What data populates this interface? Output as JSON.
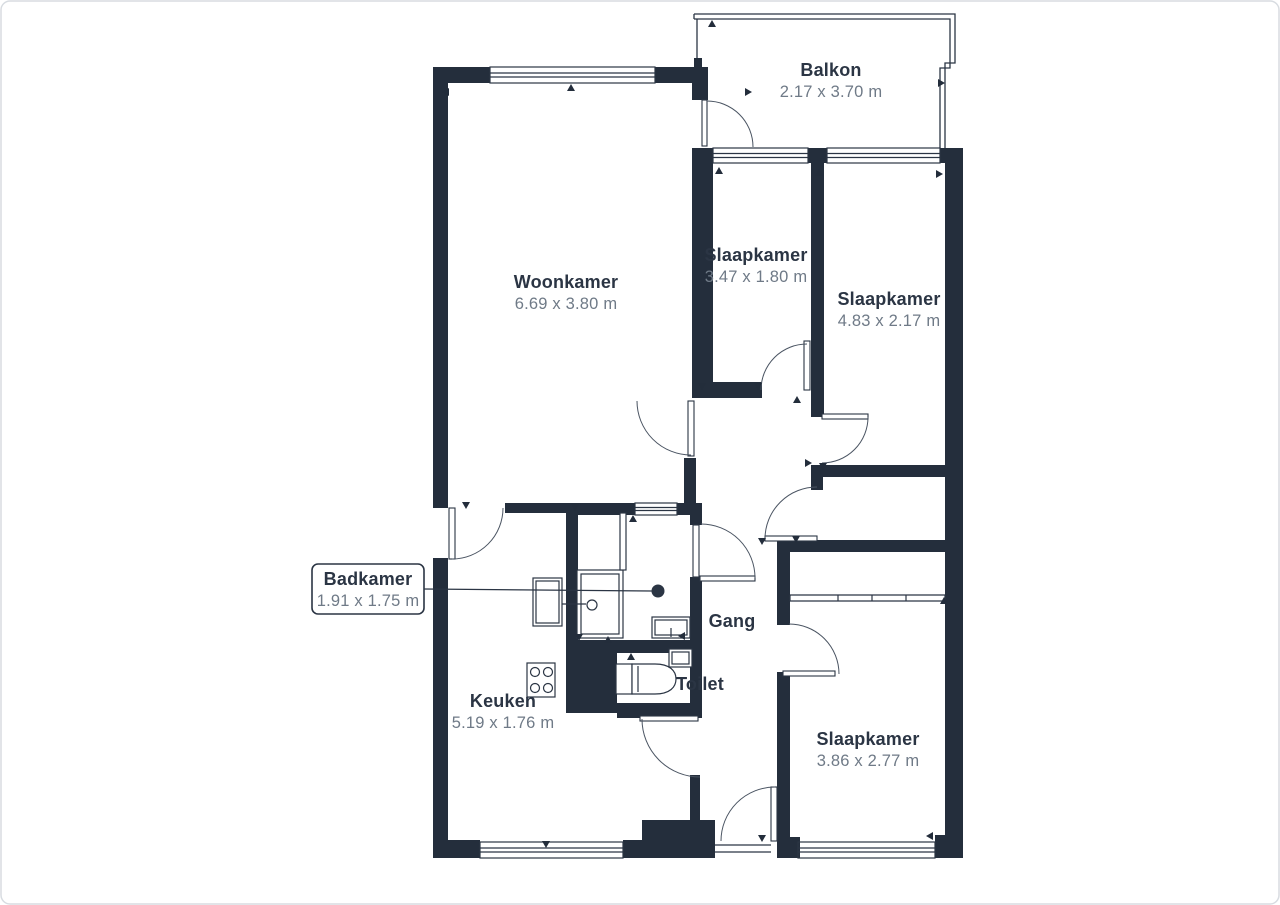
{
  "plan": {
    "title": "Apartment floor plan",
    "rooms": {
      "woonkamer": {
        "name": "Woonkamer",
        "dims": "6.69 x 3.80 m"
      },
      "balkon": {
        "name": "Balkon",
        "dims": "2.17 x 3.70 m"
      },
      "slaapkamer1": {
        "name": "Slaapkamer",
        "dims": "3.47 x 1.80 m"
      },
      "slaapkamer2": {
        "name": "Slaapkamer",
        "dims": "4.83 x 2.17 m"
      },
      "badkamer": {
        "name": "Badkamer",
        "dims": "1.91 x 1.75 m"
      },
      "keuken": {
        "name": "Keuken",
        "dims": "5.19 x 1.76 m"
      },
      "gang": {
        "name": "Gang"
      },
      "toilet": {
        "name": "Toilet"
      },
      "slaapkamer3": {
        "name": "Slaapkamer",
        "dims": "3.86 x 2.77 m"
      }
    },
    "colors": {
      "wall": "#242e3c",
      "room_name_text": "#2b3544",
      "dimension_text": "#6f7a87",
      "leader_line": "#2b3544",
      "page_border": "#d8dce1",
      "background": "#ffffff"
    }
  }
}
